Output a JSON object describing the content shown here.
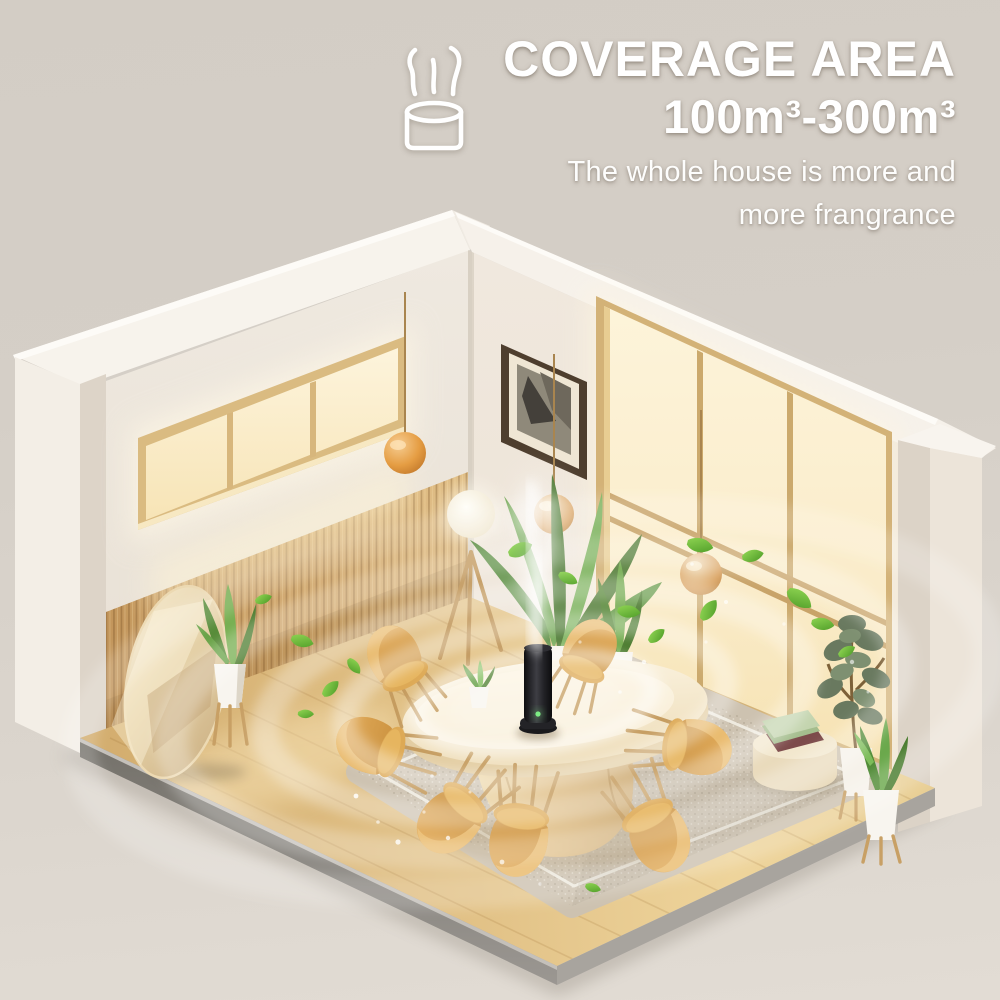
{
  "header": {
    "title": "COVERAGE AREA",
    "range": "100m³-300m³",
    "subtitle_line1": "The whole house is more and",
    "subtitle_line2": "more frangrance",
    "icon": "diffuser-mist-icon"
  },
  "scene": {
    "setting": "isometric cutaway dining room",
    "product": "black tower aroma diffuser emitting mist on dining table",
    "objects": [
      "aroma-diffuser",
      "mist-plume",
      "scent-wave-rings",
      "oval-dining-table",
      "dining-chairs",
      "area-rug",
      "ribbon-window",
      "floor-to-ceiling-window",
      "wood-slat-wainscot",
      "standing-oval-mirror",
      "pendant-lamps",
      "tripod-floor-lamp",
      "framed-art",
      "potted-plants",
      "pouf-with-books",
      "floating-leaves",
      "sparkles"
    ],
    "counts": {
      "dining_chairs": 7,
      "pendant_lamps": 3,
      "scent_wave_rings": 5
    }
  },
  "colors": {
    "background": "#d5cfc7",
    "text": "#ffffff",
    "wall": "#ece5db",
    "window_glow": "#fbeecd",
    "wood_slats": "#cda369",
    "wood_floor": "#e2c288",
    "chair": "#d9a24f",
    "pendant_orange": "#de9a43",
    "leaf_green": "#6cbf3a",
    "diffuser_black": "#1c1c1f",
    "rug": "#cdc2b0",
    "plinth_gray": "#8c8984"
  }
}
